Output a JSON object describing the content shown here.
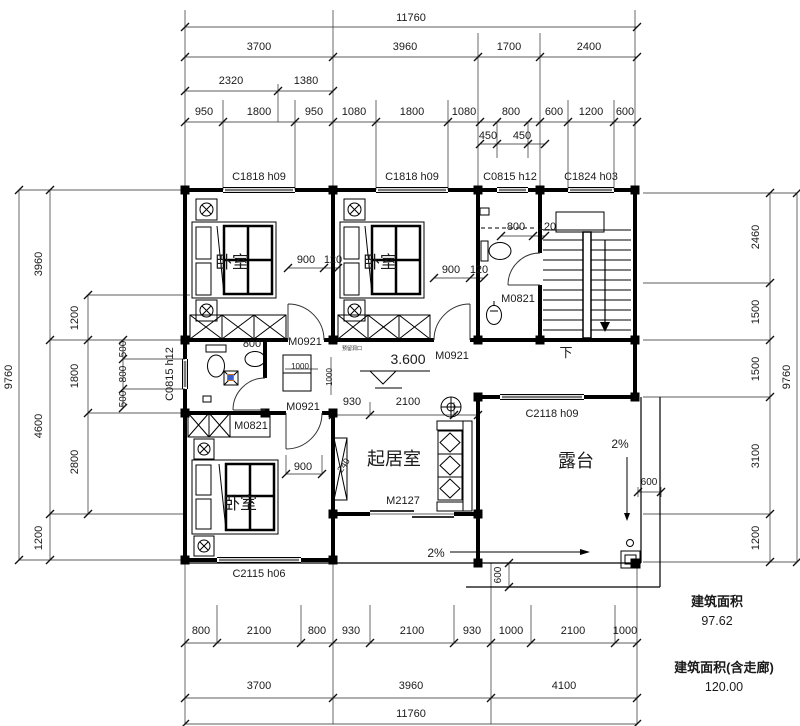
{
  "title": "floor-plan",
  "areas": {
    "label_1": "建筑面积",
    "value_1": "97.62",
    "label_2": "建筑面积(含走廊)",
    "value_2": "120.00"
  },
  "texts": [
    {
      "t": "11760",
      "x": 411,
      "y": 21,
      "n": "dim-top-total"
    },
    {
      "t": "3700",
      "x": 259,
      "y": 50
    },
    {
      "t": "3960",
      "x": 405,
      "y": 50
    },
    {
      "t": "1700",
      "x": 509,
      "y": 50
    },
    {
      "t": "2400",
      "x": 589,
      "y": 50
    },
    {
      "t": "2320",
      "x": 231,
      "y": 84
    },
    {
      "t": "1380",
      "x": 306,
      "y": 84
    },
    {
      "t": "950",
      "x": 204,
      "y": 115
    },
    {
      "t": "1800",
      "x": 259,
      "y": 115
    },
    {
      "t": "950",
      "x": 314,
      "y": 115
    },
    {
      "t": "1080",
      "x": 354,
      "y": 115
    },
    {
      "t": "1800",
      "x": 412,
      "y": 115
    },
    {
      "t": "1080",
      "x": 464,
      "y": 115
    },
    {
      "t": "800",
      "x": 511,
      "y": 115
    },
    {
      "t": "600",
      "x": 554,
      "y": 115
    },
    {
      "t": "1200",
      "x": 591,
      "y": 115
    },
    {
      "t": "600",
      "x": 625,
      "y": 115
    },
    {
      "t": "450",
      "x": 488,
      "y": 139
    },
    {
      "t": "450",
      "x": 522,
      "y": 139
    },
    {
      "t": "C1818 h09",
      "x": 259,
      "y": 180,
      "n": "window-label"
    },
    {
      "t": "C1818 h09",
      "x": 412,
      "y": 180,
      "n": "window-label"
    },
    {
      "t": "C0815 h12",
      "x": 510,
      "y": 180,
      "n": "window-label"
    },
    {
      "t": "C1824 h03",
      "x": 591,
      "y": 180,
      "n": "window-label"
    },
    {
      "t": "9760",
      "x": 12,
      "y": 377,
      "r": -90
    },
    {
      "t": "3960",
      "x": 42,
      "y": 264,
      "r": -90
    },
    {
      "t": "4600",
      "x": 42,
      "y": 426,
      "r": -90
    },
    {
      "t": "1200",
      "x": 42,
      "y": 538,
      "r": -90
    },
    {
      "t": "1200",
      "x": 78,
      "y": 318,
      "r": -90
    },
    {
      "t": "1800",
      "x": 78,
      "y": 376,
      "r": -90
    },
    {
      "t": "2800",
      "x": 78,
      "y": 462,
      "r": -90
    },
    {
      "t": "500",
      "x": 126,
      "y": 349,
      "r": -90,
      "s": 10
    },
    {
      "t": "800",
      "x": 126,
      "y": 374,
      "r": -90,
      "s": 10
    },
    {
      "t": "500",
      "x": 126,
      "y": 399,
      "r": -90,
      "s": 10
    },
    {
      "t": "C0815 h12",
      "x": 173,
      "y": 374,
      "r": -90,
      "n": "window-label"
    },
    {
      "t": "2460",
      "x": 759,
      "y": 237,
      "r": -90
    },
    {
      "t": "1500",
      "x": 759,
      "y": 312,
      "r": -90
    },
    {
      "t": "1500",
      "x": 759,
      "y": 369,
      "r": -90
    },
    {
      "t": "3100",
      "x": 759,
      "y": 456,
      "r": -90
    },
    {
      "t": "1200",
      "x": 759,
      "y": 538,
      "r": -90
    },
    {
      "t": "9760",
      "x": 790,
      "y": 377,
      "r": -90
    },
    {
      "t": "800",
      "x": 201,
      "y": 634
    },
    {
      "t": "2100",
      "x": 259,
      "y": 634
    },
    {
      "t": "800",
      "x": 317,
      "y": 634
    },
    {
      "t": "930",
      "x": 351,
      "y": 634
    },
    {
      "t": "2100",
      "x": 412,
      "y": 634
    },
    {
      "t": "930",
      "x": 472,
      "y": 634
    },
    {
      "t": "1000",
      "x": 511,
      "y": 634
    },
    {
      "t": "2100",
      "x": 573,
      "y": 634
    },
    {
      "t": "1000",
      "x": 625,
      "y": 634
    },
    {
      "t": "3700",
      "x": 259,
      "y": 689
    },
    {
      "t": "3960",
      "x": 411,
      "y": 689
    },
    {
      "t": "4100",
      "x": 564,
      "y": 689
    },
    {
      "t": "11760",
      "x": 411,
      "y": 717,
      "n": "dim-bottom-total"
    },
    {
      "t": "卧室",
      "x": 232,
      "y": 268,
      "s": 17,
      "n": "room-bedroom-1"
    },
    {
      "t": "卧室",
      "x": 380,
      "y": 268,
      "s": 17,
      "n": "room-bedroom-2"
    },
    {
      "t": "卧室",
      "x": 240,
      "y": 509,
      "s": 17,
      "n": "room-bedroom-3"
    },
    {
      "t": "起居室",
      "x": 394,
      "y": 465,
      "s": 18,
      "n": "room-living"
    },
    {
      "t": "露台",
      "x": 576,
      "y": 467,
      "s": 18,
      "n": "room-terrace"
    },
    {
      "t": "下",
      "x": 566,
      "y": 357,
      "s": 13,
      "n": "stair-down-label"
    },
    {
      "t": "M0921",
      "x": 305,
      "y": 345,
      "n": "door-label"
    },
    {
      "t": "M0921",
      "x": 452,
      "y": 359,
      "n": "door-label"
    },
    {
      "t": "M0921",
      "x": 303,
      "y": 410,
      "n": "door-label"
    },
    {
      "t": "M0821",
      "x": 518,
      "y": 302,
      "n": "door-label"
    },
    {
      "t": "M0821",
      "x": 251,
      "y": 429,
      "n": "door-label"
    },
    {
      "t": "M2127",
      "x": 403,
      "y": 504,
      "n": "door-label"
    },
    {
      "t": "C2118 h09",
      "x": 552,
      "y": 417,
      "n": "window-label"
    },
    {
      "t": "C2115 h06",
      "x": 259,
      "y": 577,
      "n": "window-label"
    },
    {
      "t": "900",
      "x": 306,
      "y": 263
    },
    {
      "t": "120",
      "x": 333,
      "y": 263
    },
    {
      "t": "900",
      "x": 451,
      "y": 273
    },
    {
      "t": "120",
      "x": 479,
      "y": 273
    },
    {
      "t": "800",
      "x": 516,
      "y": 230
    },
    {
      "t": "120",
      "x": 547,
      "y": 230
    },
    {
      "t": "800",
      "x": 252,
      "y": 347
    },
    {
      "t": "930",
      "x": 352,
      "y": 405
    },
    {
      "t": "2100",
      "x": 408,
      "y": 405
    },
    {
      "t": "1000",
      "x": 300,
      "y": 369,
      "s": 8
    },
    {
      "t": "1000",
      "x": 332,
      "y": 377,
      "r": -90,
      "s": 8
    },
    {
      "t": "3.600",
      "x": 408,
      "y": 364,
      "s": 14,
      "n": "level-mark"
    },
    {
      "t": "240",
      "x": 346,
      "y": 467,
      "s": 9,
      "r": -55
    },
    {
      "t": "900",
      "x": 303,
      "y": 470
    },
    {
      "t": "2%",
      "x": 436,
      "y": 557,
      "s": 12,
      "n": "slope-label"
    },
    {
      "t": "2%",
      "x": 620,
      "y": 448,
      "s": 12,
      "n": "slope-label"
    },
    {
      "t": "600",
      "x": 649,
      "y": 485,
      "s": 10
    },
    {
      "t": "600",
      "x": 501,
      "y": 575,
      "r": -90,
      "s": 10
    },
    {
      "t": "预留洞口",
      "x": 352,
      "y": 350,
      "s": 5,
      "n": "shaft-note"
    }
  ]
}
